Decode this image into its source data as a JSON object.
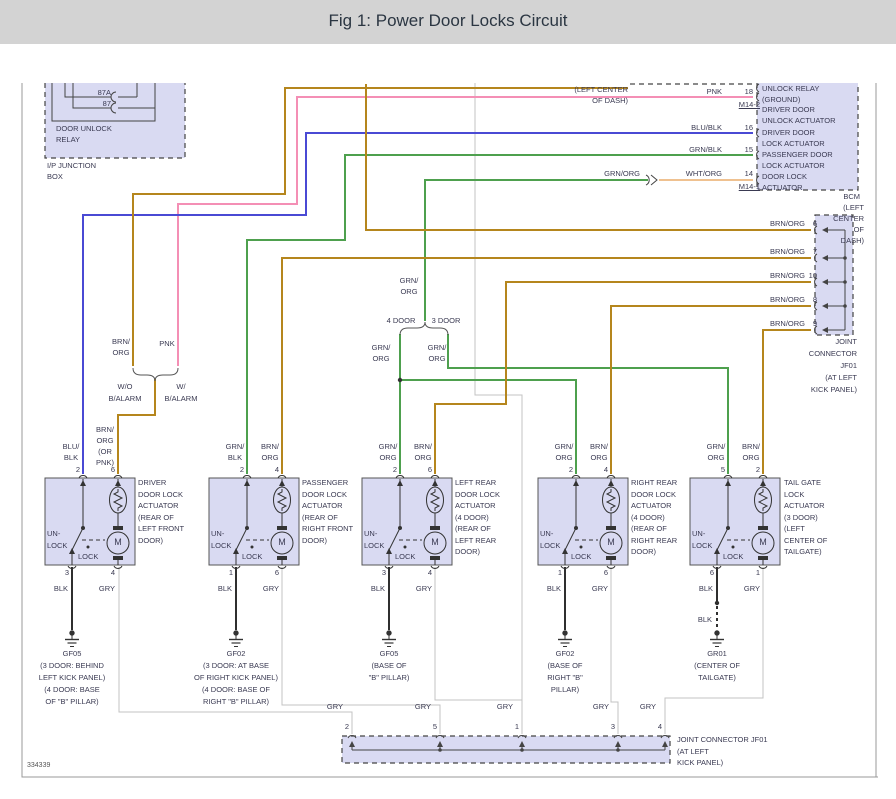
{
  "header": {
    "title": "Fig 1: Power Door Locks Circuit"
  },
  "footer": {
    "diagram_number": "334339"
  },
  "colors": {
    "header_bg": "#d3d3d3",
    "module_fill": "#d9daf2",
    "brn_org": "#b5861d",
    "pnk": "#f48fb5",
    "blu_blk": "#4a4ad4",
    "grn": "#4ea04e",
    "wht_org": "#efc190",
    "blk": "#2f2f2f",
    "gry": "#c3c3c3",
    "text": "#3a3a52"
  },
  "ip_junction_box": {
    "label": "I/P JUNCTION\nBOX",
    "relay": {
      "label": "DOOR UNLOCK\nRELAY",
      "pin_87a": "87A",
      "pin_87": "87"
    }
  },
  "upper_module_location": "(LEFT CENTER\nOF DASH)",
  "bcm": {
    "name": "BCM",
    "location": "(LEFT CENTER OF DASH)",
    "pin_ground": {
      "label": "UNLOCK RELAY\n(GROUND)"
    },
    "pin_18": {
      "wire": "PNK",
      "num": "18",
      "connector": "M14-2",
      "label": "DRIVER DOOR\nUNLOCK ACTUATOR"
    },
    "pin_16": {
      "wire": "BLU/BLK",
      "num": "16",
      "label": "DRIVER DOOR\nLOCK ACTUATOR"
    },
    "pin_15": {
      "wire": "GRN/BLK",
      "num": "15",
      "label": "PASSENGER DOOR\nLOCK ACTUATOR"
    },
    "pin_14": {
      "wire_in": "GRN/ORG",
      "wire": "WHT/ORG",
      "num": "14",
      "connector": "M14-1",
      "label": "DOOR LOCK\nACTUATOR"
    }
  },
  "jf01_right": {
    "pins": [
      {
        "wire": "BRN/ORG",
        "num": "6"
      },
      {
        "wire": "BRN/ORG",
        "num": "7"
      },
      {
        "wire": "BRN/ORG",
        "num": "10"
      },
      {
        "wire": "BRN/ORG",
        "num": "8"
      },
      {
        "wire": "BRN/ORG",
        "num": "9"
      }
    ],
    "label": "JOINT\nCONNECTOR JF01\n(AT LEFT\nKICK PANEL)"
  },
  "door_split": {
    "wire": "GRN/\nORG",
    "left_tag": "4 DOOR",
    "right_tag": "3 DOOR",
    "left_wire": "GRN/\nORG",
    "right_wire": "GRN/\nORG"
  },
  "alarm_split": {
    "left_wire": "BRN/\nORG",
    "right_wire": "PNK",
    "left_tag": "W/O\nB/ALARM",
    "right_tag": "W/\nB/ALARM",
    "merged_wire": "BRN/\nORG\n(OR\nPNK)"
  },
  "actuators": [
    {
      "name": "DRIVER\nDOOR LOCK\nACTUATOR\n(REAR OF\nLEFT FRONT\nDOOR)",
      "top_left_wire": "BLU/\nBLK",
      "top_left_pin": "2",
      "top_right_pin": "6",
      "unlock": "UN-\nLOCK",
      "lock": "LOCK",
      "motor": "M",
      "bottom_left_pin": "3",
      "bottom_left_wire": "BLK",
      "bottom_right_pin": "4",
      "bottom_right_wire": "GRY",
      "ground_id": "GF05",
      "ground_location": "(3 DOOR: BEHIND\nLEFT KICK PANEL)\n(4 DOOR: BASE\nOF \"B\" PILLAR)"
    },
    {
      "name": "PASSENGER\nDOOR LOCK\nACTUATOR\n(REAR OF\nRIGHT FRONT\nDOOR)",
      "top_left_wire": "GRN/\nBLK",
      "top_left_pin": "2",
      "top_right_wire": "BRN/\nORG",
      "top_right_pin": "4",
      "unlock": "UN-\nLOCK",
      "lock": "LOCK",
      "motor": "M",
      "bottom_left_pin": "1",
      "bottom_left_wire": "BLK",
      "bottom_right_pin": "6",
      "bottom_right_wire": "GRY",
      "ground_id": "GF02",
      "ground_location": "(3 DOOR: AT BASE\nOF RIGHT KICK PANEL)\n(4 DOOR: BASE OF\nRIGHT \"B\" PILLAR)"
    },
    {
      "name": "LEFT REAR\nDOOR LOCK\nACTUATOR\n(4 DOOR)\n(REAR OF\nLEFT REAR\nDOOR)",
      "top_left_wire": "GRN/\nORG",
      "top_left_pin": "2",
      "top_right_wire": "BRN/\nORG",
      "top_right_pin": "6",
      "unlock": "UN-\nLOCK",
      "lock": "LOCK",
      "motor": "M",
      "bottom_left_pin": "3",
      "bottom_left_wire": "BLK",
      "bottom_right_pin": "4",
      "bottom_right_wire": "GRY",
      "ground_id": "GF05",
      "ground_location": "(BASE OF\n\"B\" PILLAR)"
    },
    {
      "name": "RIGHT REAR\nDOOR LOCK\nACTUATOR\n(4 DOOR)\n(REAR OF\nRIGHT REAR\nDOOR)",
      "top_left_wire": "GRN/\nORG",
      "top_left_pin": "2",
      "top_right_wire": "BRN/\nORG",
      "top_right_pin": "4",
      "unlock": "UN-\nLOCK",
      "lock": "LOCK",
      "motor": "M",
      "bottom_left_pin": "1",
      "bottom_left_wire": "BLK",
      "bottom_right_pin": "6",
      "bottom_right_wire": "GRY",
      "ground_id": "GF02",
      "ground_location": "(BASE OF\nRIGHT \"B\"\nPILLAR)"
    },
    {
      "name": "TAIL GATE\nLOCK\nACTUATOR\n(3 DOOR)\n(LEFT\nCENTER OF\nTAILGATE)",
      "top_left_wire": "GRN/\nORG",
      "top_left_pin": "5",
      "top_right_wire": "BRN/\nORG",
      "top_right_pin": "2",
      "unlock": "UN-\nLOCK",
      "lock": "LOCK",
      "motor": "M",
      "bottom_left_pin": "6",
      "bottom_left_wire": "BLK",
      "mid_wire": "BLK",
      "bottom_right_pin": "1",
      "bottom_right_wire": "GRY",
      "ground_id": "GR01",
      "ground_location": "(CENTER OF\nTAILGATE)"
    }
  ],
  "jf01_bottom": {
    "pins": [
      {
        "wire": "GRY",
        "num": "2"
      },
      {
        "wire": "GRY",
        "num": "5"
      },
      {
        "wire": "GRY",
        "num": "1"
      },
      {
        "wire": "GRY",
        "num": "3"
      },
      {
        "wire": "GRY",
        "num": "4"
      }
    ],
    "label": "JOINT CONNECTOR JF01\n(AT LEFT\nKICK PANEL)"
  }
}
